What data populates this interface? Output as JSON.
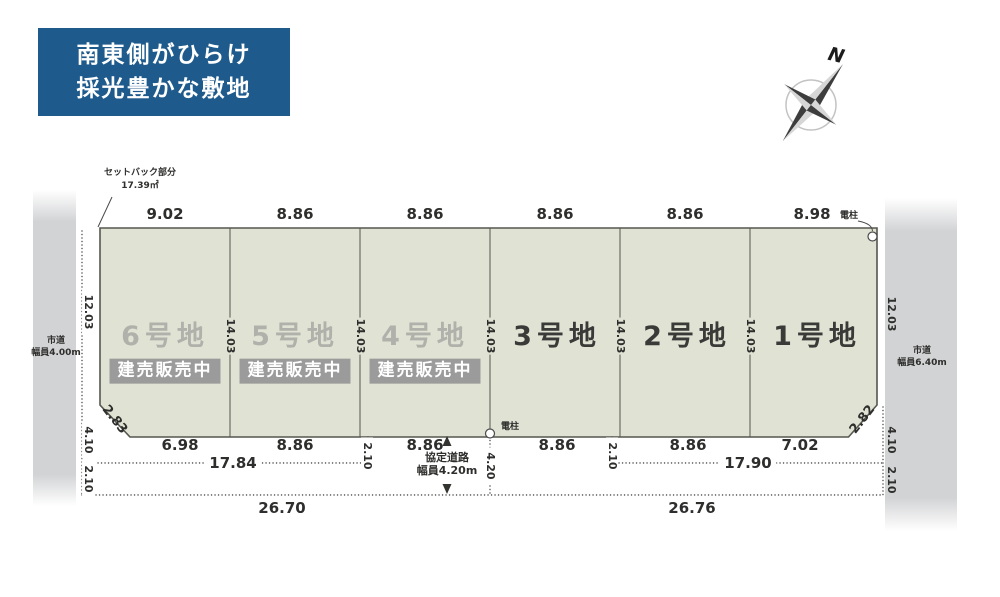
{
  "header": {
    "line1": "南東側がひらけ",
    "line2": "採光豊かな敷地"
  },
  "compass": {
    "north": "N"
  },
  "site": {
    "setback": {
      "title": "セットバック部分",
      "area": "17.39㎡"
    },
    "pole": "電柱",
    "roads": {
      "left_name": "市道",
      "left_width": "幅員4.00m",
      "right_name": "市道",
      "right_width": "幅員6.40m",
      "agreement_name": "協定道路",
      "agreement_width": "幅員4.20m"
    },
    "plots": [
      {
        "name": "6号地",
        "status": "建売販売中",
        "top": "9.02",
        "bottom": "6.98"
      },
      {
        "name": "5号地",
        "status": "建売販売中",
        "top": "8.86",
        "bottom": "8.86"
      },
      {
        "name": "4号地",
        "status": "建売販売中",
        "top": "8.86",
        "bottom": "8.86"
      },
      {
        "name": "3号地",
        "top": "8.86",
        "bottom": "8.86"
      },
      {
        "name": "2号地",
        "top": "8.86",
        "bottom": "8.86"
      },
      {
        "name": "1号地",
        "top": "8.98",
        "bottom": "7.02"
      }
    ],
    "dims": {
      "depth": "14.03",
      "left_side": [
        "12.03",
        "4.10",
        "2.10"
      ],
      "right_side": [
        "12.03",
        "4.10",
        "2.10"
      ],
      "corner_left": "2.83",
      "corner_right": "2.82",
      "offset_left": "2.10",
      "offset_center": "4.20",
      "offset_right": "2.10",
      "span_left_inner": "17.84",
      "span_right_inner": "17.90",
      "span_left_total": "26.70",
      "span_right_total": "26.76"
    }
  },
  "colors": {
    "header_bg": "#1e5a8c",
    "plot_fill": "#e0e3d4",
    "plot_stroke": "#55564e",
    "road_fill": "#d2d3d5",
    "badge_bg": "#9b9b9b",
    "muted_label": "#b0b1ab",
    "dark_label": "#3a3a38"
  }
}
